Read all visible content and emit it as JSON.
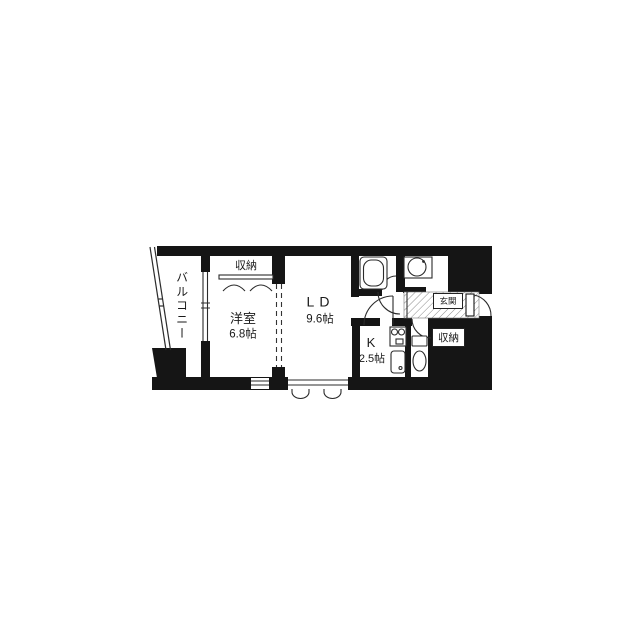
{
  "page": {
    "background": "#ffffff"
  },
  "floorplan": {
    "type": "apartment-floorplan",
    "rooms": {
      "balcony": {
        "label": "バルコニー"
      },
      "closet_top": {
        "label": "収納"
      },
      "western_room": {
        "label": "洋室",
        "size": "6.8帖"
      },
      "living_dining": {
        "label": "LD",
        "size": "9.6帖"
      },
      "kitchen": {
        "label": "K",
        "size": "2.5帖"
      },
      "entrance": {
        "label": "玄関"
      },
      "closet_entrance": {
        "label": "収納"
      }
    },
    "fixtures": [
      "bathtub",
      "washbasin",
      "stove",
      "kitchen-sink",
      "toilet"
    ],
    "colors": {
      "wall": "#151515",
      "line": "#2b2b2b",
      "hatch": "#8a8a8a",
      "text": "#1a1a1a",
      "background": "#ffffff"
    }
  }
}
